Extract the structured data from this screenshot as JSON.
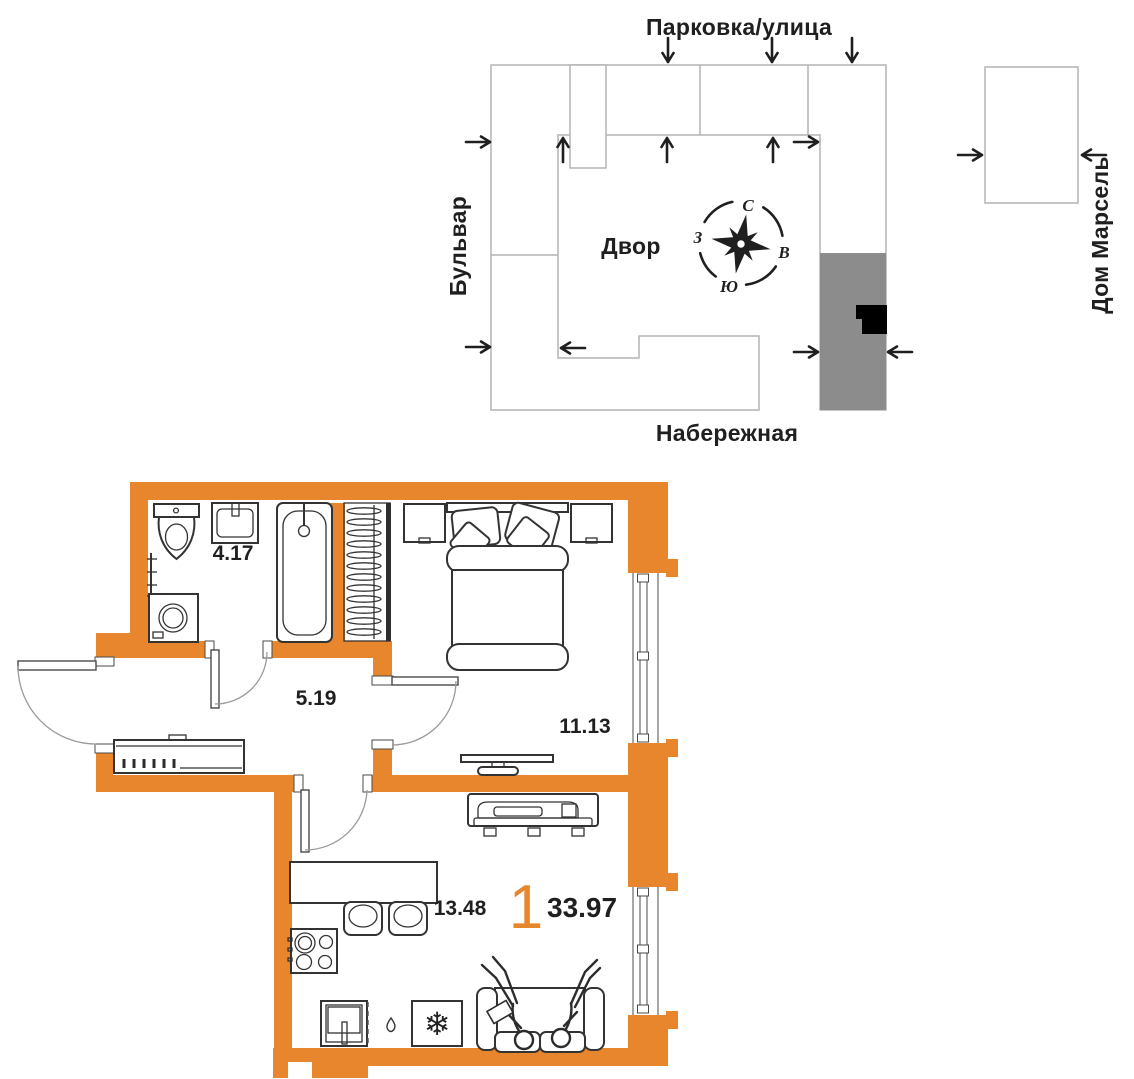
{
  "site_plan": {
    "street_top": "Парковка/улица",
    "street_left": "Бульвар",
    "street_bottom": "Набережная",
    "building_right": "Дом Марсель",
    "courtyard": "Двор",
    "compass": {
      "n": "С",
      "e": "В",
      "s": "Ю",
      "w": "З"
    }
  },
  "floor_plan": {
    "rooms": [
      {
        "name": "bathroom",
        "area": "4.17"
      },
      {
        "name": "hallway",
        "area": "5.19"
      },
      {
        "name": "bedroom",
        "area": "11.13"
      },
      {
        "name": "kitchen-living",
        "area": "13.48"
      }
    ],
    "rooms_count": "1",
    "total_area": "33.97"
  },
  "colors": {
    "wall": "#E8862D",
    "section_highlight": "#8C8C8C",
    "location_marker": "#000000",
    "site_outline": "#B3B3B3",
    "ink": "#1F1F1F"
  }
}
